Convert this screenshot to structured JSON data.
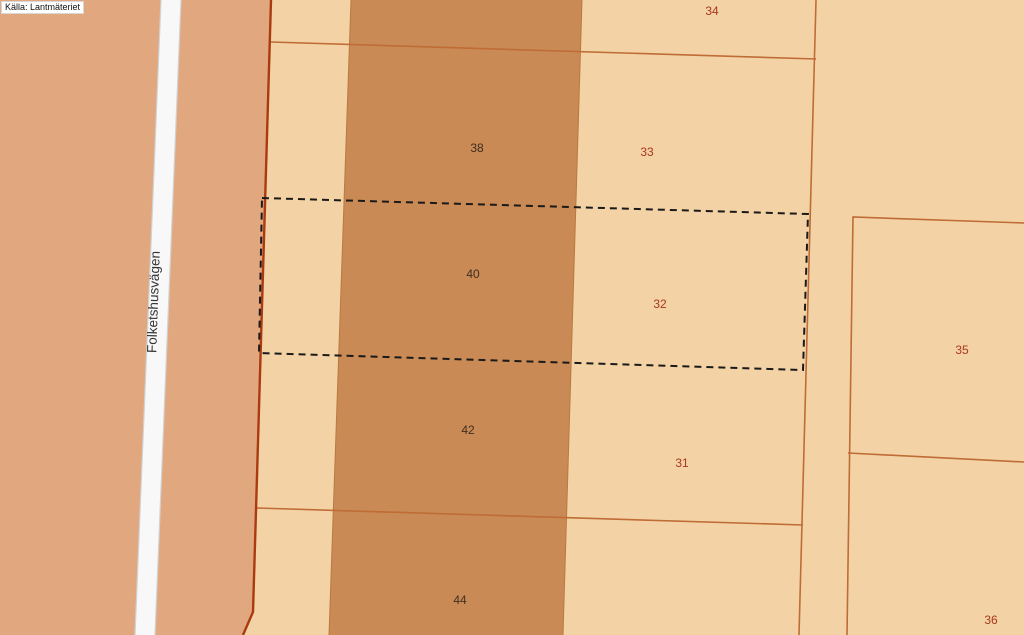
{
  "source": {
    "label": "Källa: Lantmäteriet"
  },
  "road": {
    "name": "Folketshusvägen"
  },
  "parcel_labels": [
    {
      "text": "34",
      "color": "#a8371f"
    },
    {
      "text": "38",
      "color": "#3f2f1f"
    },
    {
      "text": "33",
      "color": "#a8371f"
    },
    {
      "text": "40",
      "color": "#3f2f1f"
    },
    {
      "text": "32",
      "color": "#a8371f"
    },
    {
      "text": "35",
      "color": "#a8371f"
    },
    {
      "text": "42",
      "color": "#3f2f1f"
    },
    {
      "text": "31",
      "color": "#a8371f"
    },
    {
      "text": "44",
      "color": "#3f2f1f"
    },
    {
      "text": "36",
      "color": "#a8371f"
    }
  ],
  "colors": {
    "background_left": "#e1a87f",
    "parcel_light": "#f3d3a5",
    "parcel_highlight": "#c98a55",
    "boundary": "#bf6c36",
    "boundary_strong": "#ab3a10",
    "band_edge": "#b97a3f",
    "road_fill": "#f8f8f8",
    "road_edge": "#d2d2d2",
    "selection_dash": "#1a1a1a",
    "road_label_color": "#333333"
  }
}
